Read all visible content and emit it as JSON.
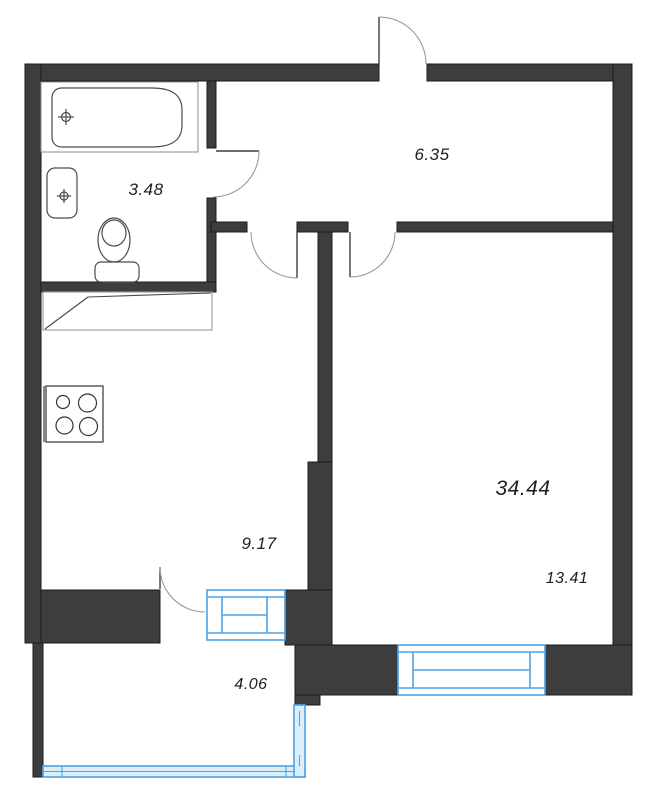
{
  "plan": {
    "type": "apartment-floor-plan",
    "total_area_label": "34.44",
    "rooms": [
      {
        "id": "bathroom",
        "area": "3.48"
      },
      {
        "id": "hallway",
        "area": "6.35"
      },
      {
        "id": "kitchen",
        "area": "9.17"
      },
      {
        "id": "living-room",
        "area": "13.41"
      },
      {
        "id": "balcony",
        "area": "4.06"
      }
    ],
    "fixtures": [
      "bathtub",
      "sink",
      "toilet",
      "stove-hob",
      "counter"
    ],
    "colors": {
      "wall": "#3d3d3d",
      "wall_outline": "#1b1b1b",
      "window_frame": "#4da2e8",
      "window_fill": "#ddeefb",
      "fixture_line": "#4a4a4a",
      "door_arc": "#9a9a9a",
      "label": "#1e1e1e",
      "background": "#ffffff"
    }
  }
}
